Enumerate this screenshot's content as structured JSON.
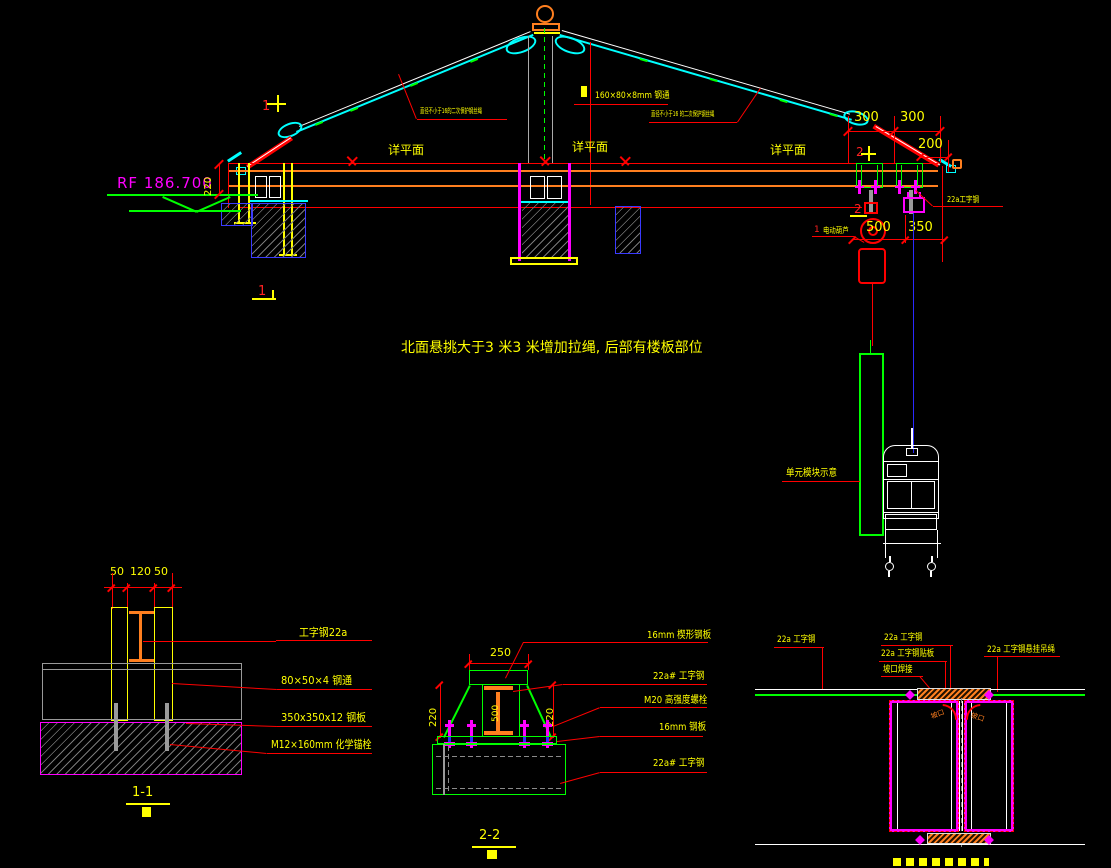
{
  "colors": {
    "cyan": "#00ffff",
    "red": "#ff0000",
    "yellow": "#ffff00",
    "orange": "#ff7f1f",
    "magenta": "#ff00ff",
    "green": "#00ff00",
    "blue": "#2a2aff",
    "white": "#ffffff",
    "gray": "#9a9a9a"
  },
  "elevation": {
    "level_label": "RF  186.700",
    "caption": "北面悬挑大于3 米3 米增加拉绳, 后部有楼板部位",
    "plan_ref": "详平面",
    "rope_left": "直径不小于16的二次保护钢丝绳",
    "rope_right": "直径不小于16 的二次保护钢丝绳",
    "tube": "160×80×8mm 钢通",
    "beam": "22a工字钢",
    "hoist_no": "1",
    "hoist": "电动葫芦",
    "module": "单元模块示意",
    "marker1": "1",
    "marker2": "2",
    "dims": {
      "d220": "220",
      "d300": "300",
      "d200": "200",
      "d500": "500",
      "d350": "350"
    }
  },
  "detail11": {
    "title": "1-1",
    "d50": "50",
    "d120": "120",
    "labels": [
      "工字钢22a",
      "80×50×4 钢通",
      "350x350x12 钢板",
      "M12×160mm 化学锚栓"
    ]
  },
  "detail22": {
    "title": "2-2",
    "d250": "250",
    "d220": "220",
    "d500": "500",
    "labels": [
      "16mm 楔形钢板",
      "22a# 工字钢",
      "M20 高强度螺栓",
      "16mm 钢板",
      "22a# 工字钢"
    ]
  },
  "detail33": {
    "labels": [
      "22a 工字钢",
      "22a 工字钢",
      "22a 工字钢贴板",
      "坡口焊接",
      "22a 工字钢悬挂吊绳"
    ],
    "weld": "坡口"
  }
}
